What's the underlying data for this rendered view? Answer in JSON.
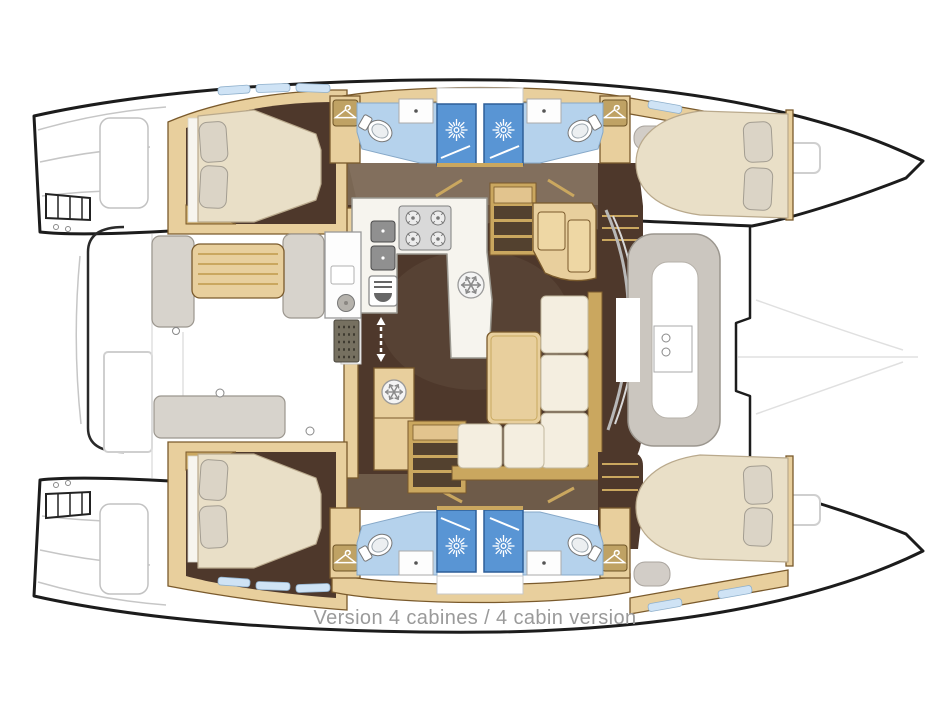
{
  "caption": {
    "text": "Version 4 cabines / 4 cabin version"
  },
  "diagram": {
    "type": "boat-floorplan",
    "subject": "catamaran interior layout, 4 cabin version",
    "orientation": "bow-right",
    "features": {
      "double_cabins": 4,
      "bathrooms": 4,
      "showers": 4,
      "saloon_galley": 1,
      "aft_cockpit": 1,
      "bow_lounge": 1
    },
    "icons": {
      "shower": "sunburst-icon",
      "refrigerator": "snowflake-icon",
      "wardrobe": "hanger-icon",
      "stove": "four-burner-icon",
      "companionway": "double-arrow-icon"
    },
    "palette": {
      "hull_outline": "#1c1c1c",
      "wood_trim": "#e8cf9d",
      "wood_border": "#7a5a2c",
      "cabin_floor": "#4e382b",
      "walkway_taupe": "#7a6754",
      "bathroom_floor": "#b5d2ec",
      "shower_stall": "#5995d4",
      "mattress": "#e9dfc7",
      "pillow": "#dbd4c6",
      "sofa": "#f4eee0",
      "counter": "#f6f4ee",
      "cockpit_cushion": "#d7d3cc",
      "caption_text": "#9a9a9a"
    }
  }
}
